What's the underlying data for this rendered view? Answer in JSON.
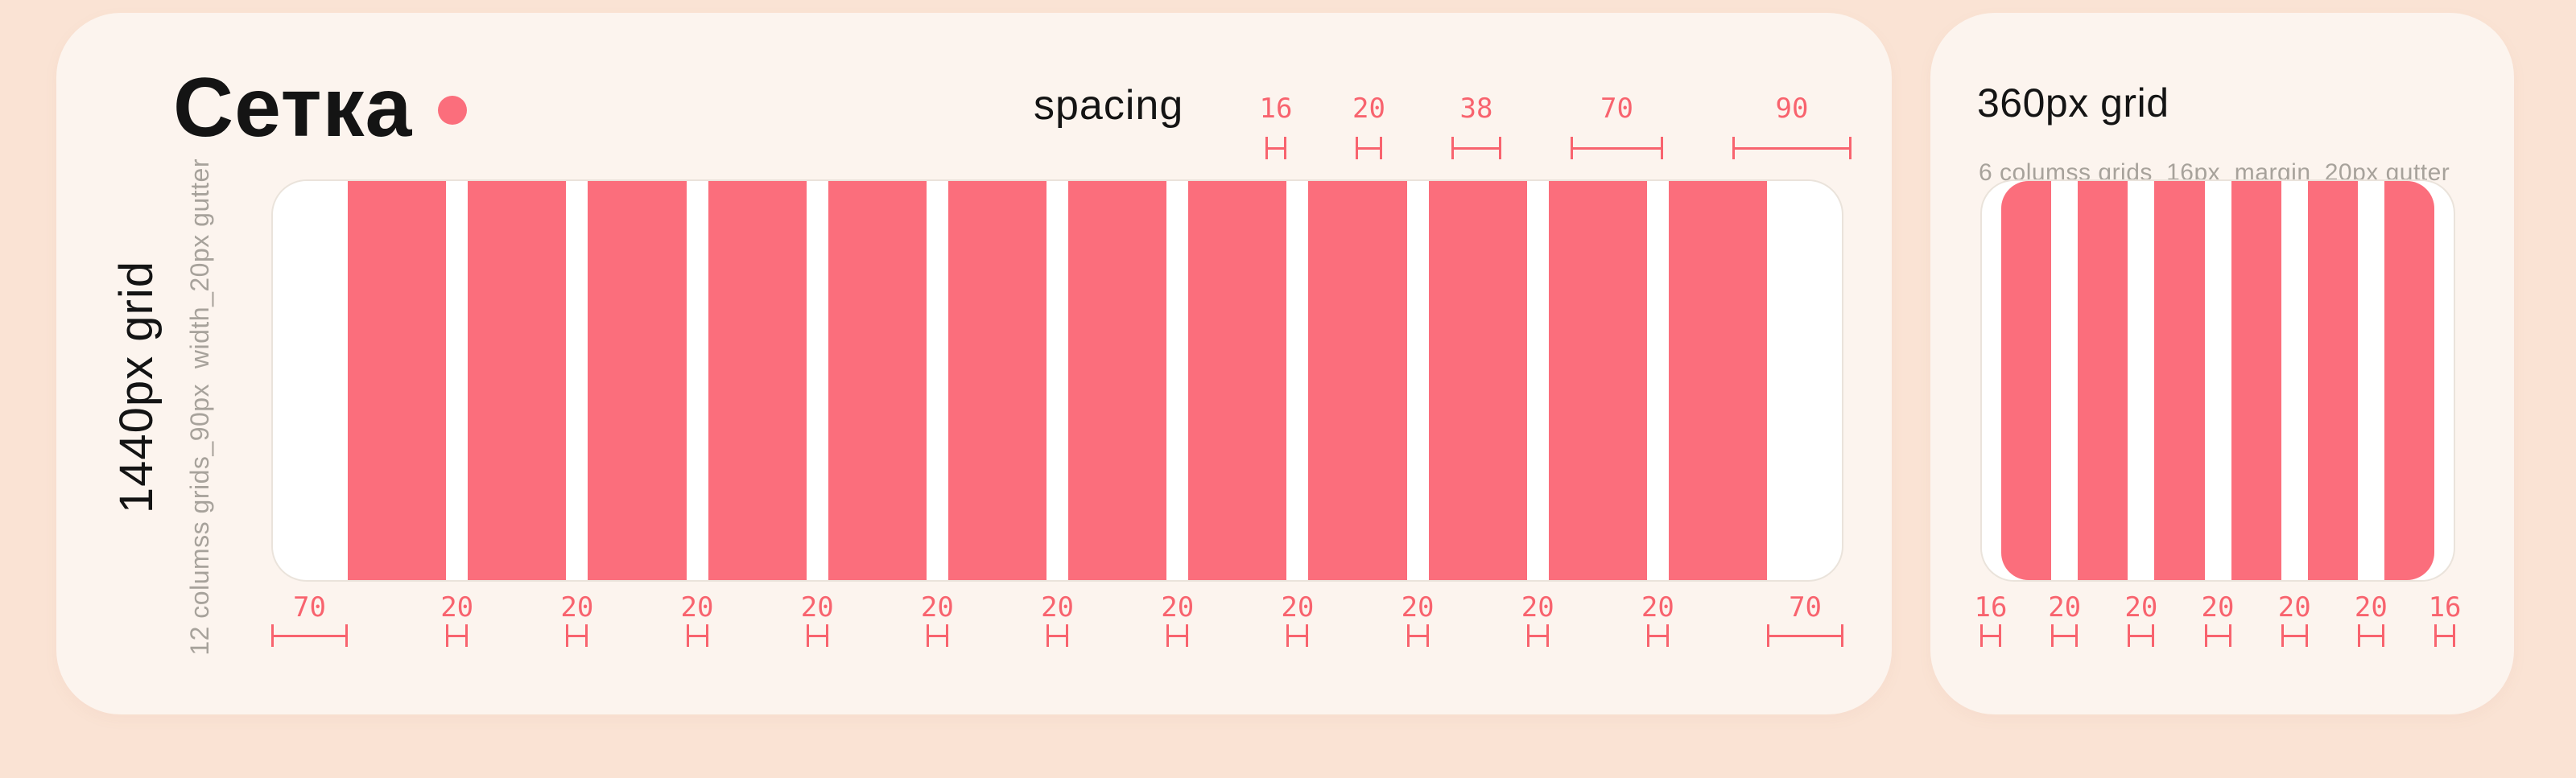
{
  "colors": {
    "page_bg": "#fae3d4",
    "card_bg": "#fcf4ee",
    "accent_pink": "#fb6e7c",
    "measure_pink": "#f8636e",
    "text_black": "#141414",
    "text_gray": "#a7a29b"
  },
  "main_card": {
    "title": "Сетка",
    "spacing_label": "spacing",
    "spacing_tokens": [
      "16",
      "20",
      "38",
      "70",
      "90"
    ],
    "vertical_title": "1440px grid",
    "vertical_subtitle": "12 columss grids_90px  width_20px gutter",
    "column_count": 12,
    "measurements": [
      "70",
      "20",
      "20",
      "20",
      "20",
      "20",
      "20",
      "20",
      "20",
      "20",
      "20",
      "20",
      "70"
    ]
  },
  "secondary_card": {
    "title": "360px grid",
    "subtitle": "6 columss grids_16px  margin_20px gutter",
    "column_count": 6,
    "measurements": [
      "16",
      "20",
      "20",
      "20",
      "20",
      "20",
      "16"
    ]
  }
}
